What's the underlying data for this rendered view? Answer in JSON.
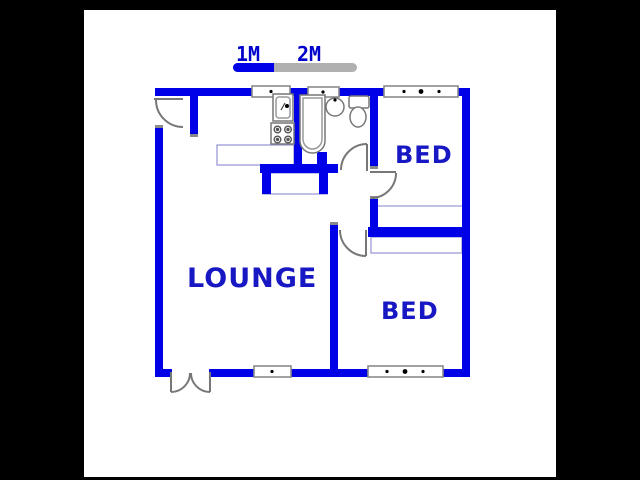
{
  "title": "2 bedroom floor plan",
  "scale_bar": {
    "label_1m": "1M",
    "label_2m": "2M",
    "blue_segment_color": "#0000e8",
    "gray_segment_color": "#b0b0b0"
  },
  "rooms": {
    "lounge": {
      "label": "LOUNGE"
    },
    "bedroom1": {
      "label": "BED"
    },
    "bedroom2": {
      "label": "BED"
    }
  },
  "fixtures": [
    "kitchen-sink",
    "stove",
    "kitchen-counter",
    "bathtub",
    "wash-basin",
    "toilet",
    "built-in-cupboard-bed1",
    "built-in-cupboard-bed2",
    "lounge-counter"
  ],
  "doors": [
    "entry-door",
    "french-double-door",
    "bathroom-door",
    "bedroom1-door",
    "bedroom2-door"
  ],
  "windows_count": 5,
  "colors": {
    "background": "#000000",
    "paper": "#ffffff",
    "wall": "#0000e8",
    "label_text": "#1717c3",
    "door_line": "#777777",
    "fixture_outline": "#777777",
    "light_outline": "#9a9ad8"
  }
}
